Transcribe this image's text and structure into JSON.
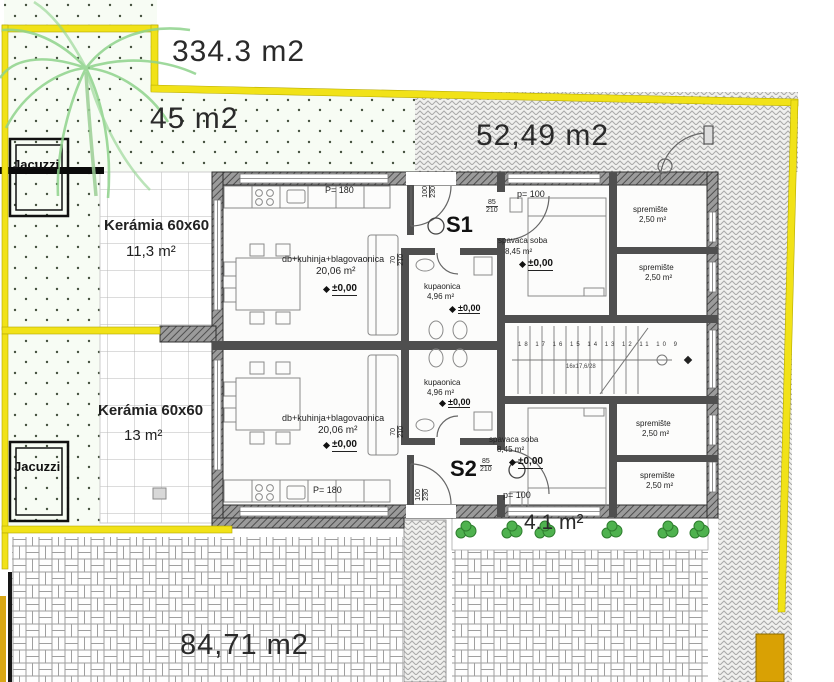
{
  "outdoor": {
    "total_area": "334.3 m2",
    "terrace_top_area": "45 m2",
    "yard_right_area": "52,49 m2",
    "yard_bottom_area": "84,71 m2",
    "green_strip_area": "4.1 m²",
    "keramia_top": {
      "label": "Kerámia 60x60",
      "area": "11,3 m²"
    },
    "keramia_bottom": {
      "label": "Kerámia 60x60",
      "area": "13 m²"
    },
    "jacuzzi_top_label": "Jacuzzi",
    "jacuzzi_bottom_label": "Jacuzzi"
  },
  "unit_s1": {
    "id": "S1",
    "door_w": "85",
    "door_h": "210",
    "entry_w": "100",
    "entry_h": "230",
    "bath_door_w": "70",
    "bath_door_h": "210",
    "kitchen_window": "P= 180",
    "bedroom_window": "p= 100",
    "living": {
      "name": "db+kuhinja+blagovaonica",
      "area": "20,06 m²",
      "level": "±0,00"
    },
    "bath": {
      "name": "kupaonica",
      "area": "4,96 m²",
      "level": "±0,00"
    },
    "bedroom": {
      "name": "spavaca soba",
      "area": "8,45 m²",
      "level": "±0,00"
    },
    "storage_a": {
      "name": "spremište",
      "area": "2,50 m²"
    },
    "storage_b": {
      "name": "spremište",
      "area": "2,50 m²"
    }
  },
  "unit_s2": {
    "id": "S2",
    "door_w": "85",
    "door_h": "210",
    "entry_w": "100",
    "entry_h": "230",
    "bath_door_w": "70",
    "bath_door_h": "210",
    "kitchen_window": "P= 180",
    "bedroom_window": "p= 100",
    "living": {
      "name": "db+kuhinja+blagovaonica",
      "area": "20,06 m²",
      "level": "±0,00"
    },
    "bath": {
      "name": "kupaonica",
      "area": "4,96 m²",
      "level": "±0,00"
    },
    "bedroom": {
      "name": "spavaca soba",
      "area": "8,45 m²",
      "level": "±0,00"
    },
    "storage_a": {
      "name": "spremište",
      "area": "2,50 m²"
    },
    "storage_b": {
      "name": "spremište",
      "area": "2,50 m²"
    }
  },
  "stairs": {
    "steps": "18 17 16 15 14 13 12 11 10 9",
    "spec": "16x17,6/28"
  },
  "colors": {
    "boundary_yellow": "#f1e218",
    "gate_orange": "#d9a104",
    "palm_green": "#8fd38c",
    "bush_green": "#4fb24f",
    "wall_dark": "#4f4f4f"
  }
}
